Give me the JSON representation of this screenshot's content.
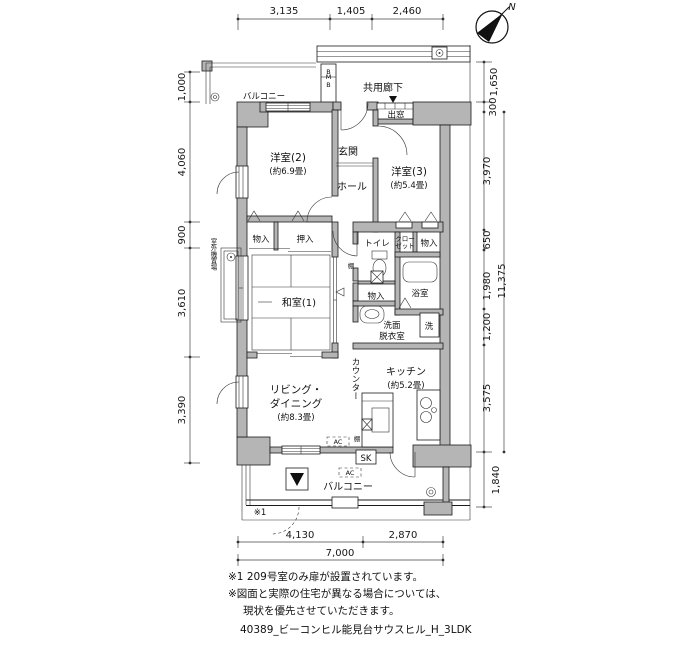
{
  "compass": {
    "north": "N"
  },
  "dims": {
    "top": [
      "3,135",
      "1,405",
      "2,460"
    ],
    "left": [
      "1,000",
      "4,060",
      "900",
      "3,610",
      "3,390"
    ],
    "right": [
      "1,650",
      "300",
      "3,970",
      "650",
      "1,980",
      "11,375",
      "1,200",
      "3,575",
      "1,840"
    ],
    "bottom": [
      "4,130",
      "2,870",
      "7,000"
    ]
  },
  "labels": {
    "balcony_top": "バルコニー",
    "mb_top": "B",
    "mb": "MB",
    "common_corridor": "共用廊下",
    "bay_window": "出窓",
    "entrance": "玄関",
    "hall": "ホール",
    "room2": "洋室(2)",
    "room2_size": "(約6.9畳)",
    "room3": "洋室(3)",
    "room3_size": "(約5.4畳)",
    "storage1": "物入",
    "oshiire": "押入",
    "toilet": "トイレ",
    "closet_l1": "クロー",
    "closet_l2": "ゼット",
    "storage2": "物入",
    "storage3": "物入",
    "shelf1": "棚",
    "shelf2": "棚",
    "bath": "浴室",
    "washroom_l1": "洗面",
    "washroom_l2": "脱衣室",
    "washer": "洗",
    "washitsu": "和室(1)",
    "outdoor_unit": "室外機置場",
    "living_l1": "リビング・",
    "living_l2": "ダイニング",
    "living_l3": "(約8.3畳)",
    "kitchen": "キッチン",
    "kitchen_size": "(約5.2畳)",
    "counter": "カウンター",
    "ac1": "AC",
    "ac2": "AC",
    "sk": "SK",
    "balcony_bottom": "バルコニー",
    "note_ref": "※1"
  },
  "notes": {
    "line1": "※1 209号室のみ扉が設置されています。",
    "line2": "※図面と実際の住宅が異なる場合については、",
    "line3": "現状を優先させていただきます。",
    "filename": "40389_ビーコンヒル能見台サウスヒル_H_3LDK"
  }
}
